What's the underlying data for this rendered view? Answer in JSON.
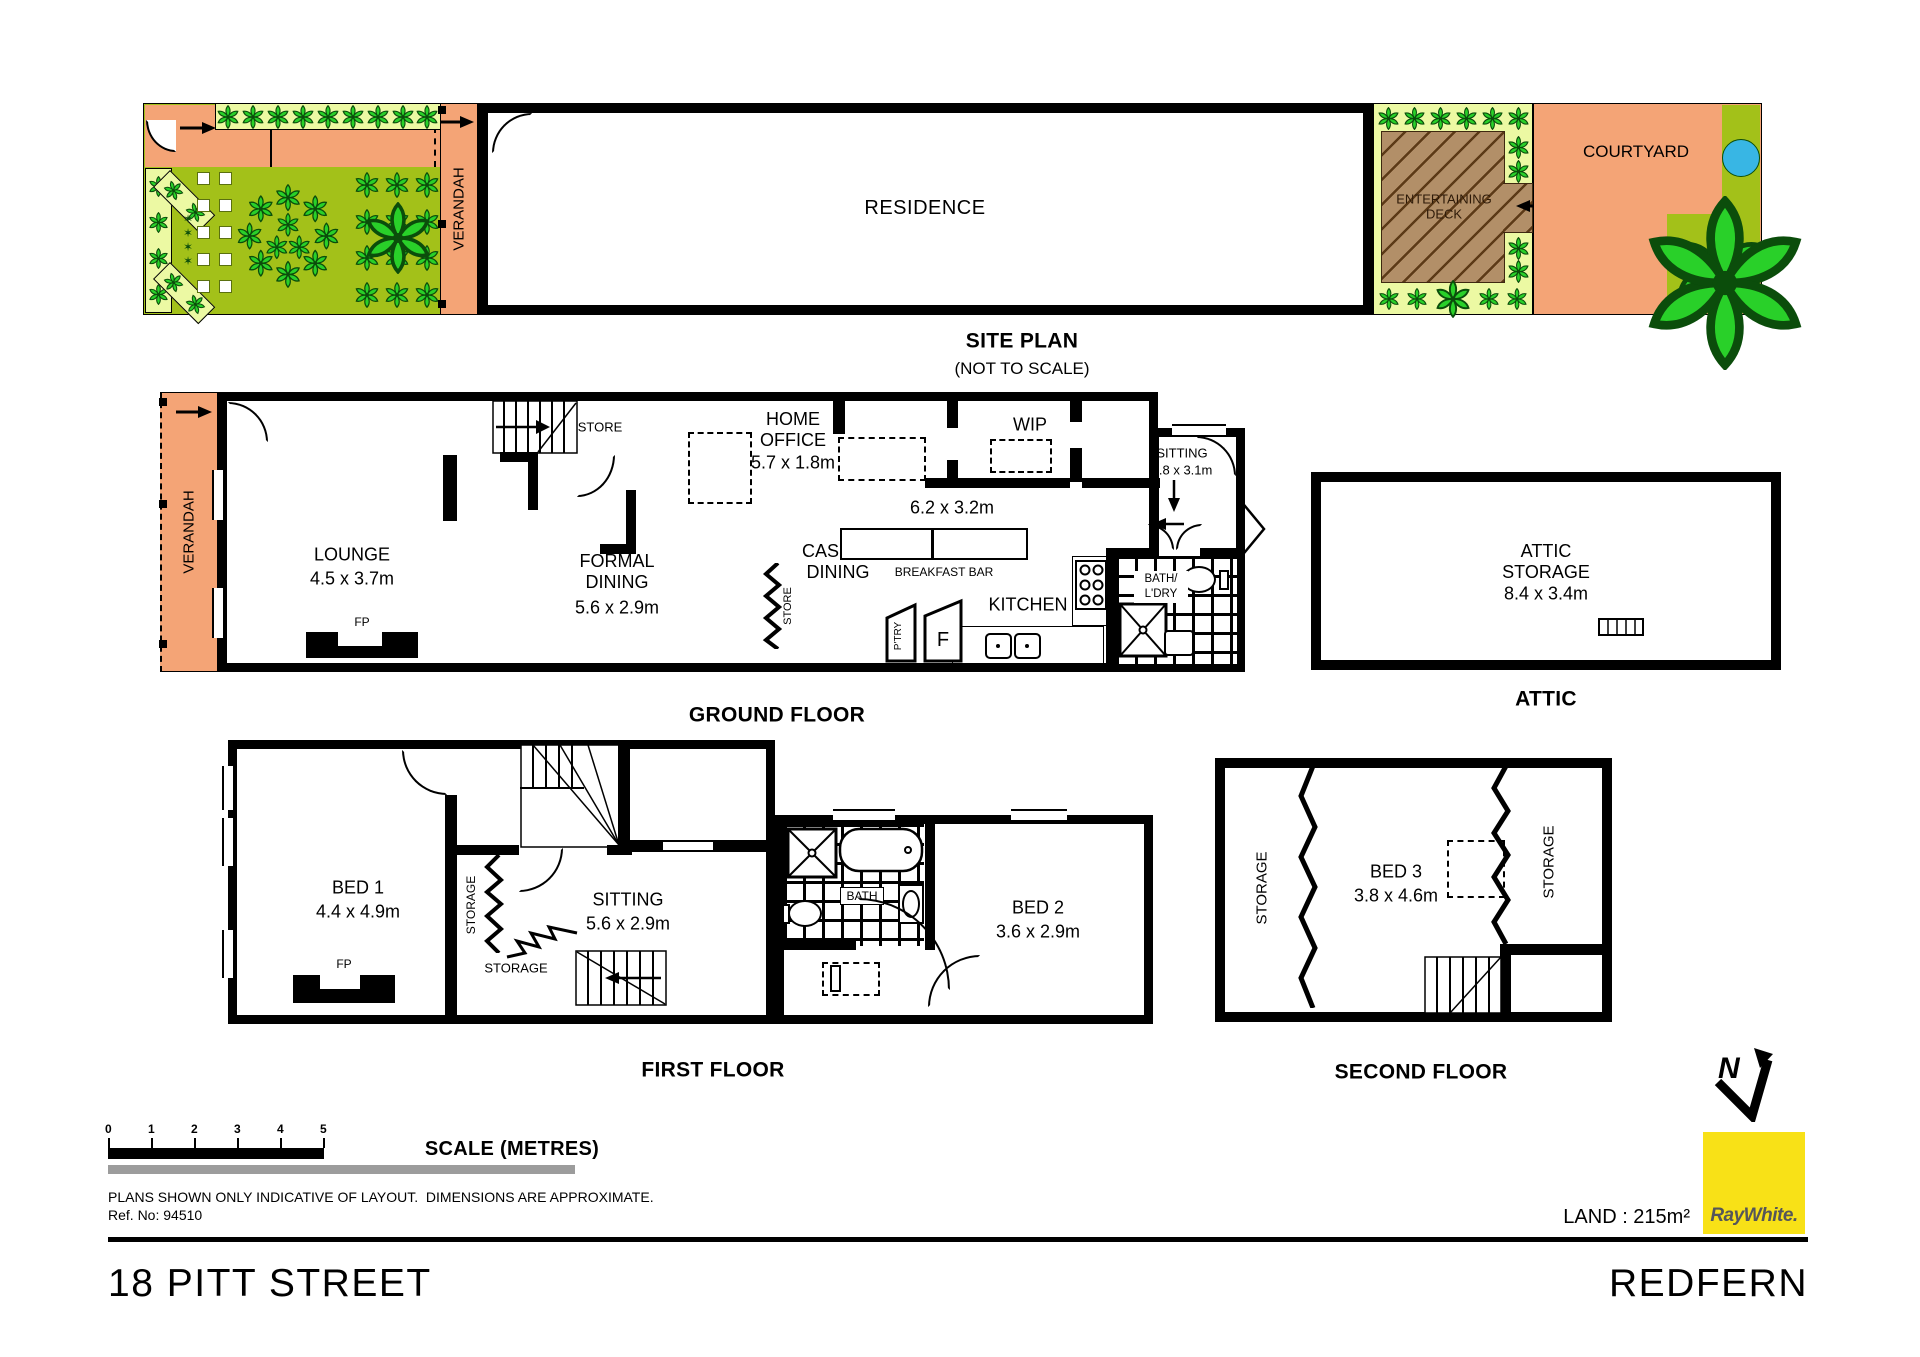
{
  "colors": {
    "salmon": "#F4A476",
    "pale_green": "#ECF9A3",
    "olive_green": "#A3C119",
    "leaf_green": "#29D029",
    "leaf_outline": "#0B4D0B",
    "deck_brown": "#B28F68",
    "pool_blue": "#38B6E4",
    "brand_yellow": "#F8E117",
    "brand_text": "#55565A"
  },
  "site": {
    "title": "SITE PLAN",
    "subtitle": "(NOT TO SCALE)",
    "residence": "RESIDENCE",
    "verandah": "VERANDAH",
    "deck": "ENTERTAINING DECK",
    "courtyard": "COURTYARD"
  },
  "ground": {
    "title": "GROUND FLOOR",
    "verandah": "VERANDAH",
    "lounge_name": "LOUNGE",
    "lounge_dims": "4.5 x 3.7m",
    "formal_name": "FORMAL DINING",
    "formal_dims": "5.6 x 2.9m",
    "casual_name": "CASUAL DINING",
    "office_name": "HOME OFFICE",
    "office_dims": "5.7 x 1.8m",
    "wip": "WIP",
    "kitchen": "KITCHEN",
    "kitchen_dims": "6.2 x 3.2m",
    "breakfast_bar": "BREAKFAST BAR",
    "sitting_name": "SITTING",
    "sitting_dims": "2.8 x 3.1m",
    "bath_line1": "BATH/",
    "bath_line2": "L'DRY",
    "store_upper": "STORE",
    "store_lower": "STORE",
    "pantry": "P'TRY",
    "fridge": "F",
    "fp": "FP"
  },
  "attic": {
    "title": "ATTIC",
    "name": "ATTIC STORAGE",
    "dims": "8.4 x 3.4m"
  },
  "first": {
    "title": "FIRST FLOOR",
    "bed1_name": "BED 1",
    "bed1_dims": "4.4 x 4.9m",
    "sitting_name": "SITTING",
    "sitting_dims": "5.6 x 2.9m",
    "bed2_name": "BED 2",
    "bed2_dims": "3.6 x 2.9m",
    "bath": "BATH",
    "storage_side": "STORAGE",
    "storage_lower": "STORAGE",
    "fp": "FP"
  },
  "second": {
    "title": "SECOND FLOOR",
    "bed3_name": "BED 3",
    "bed3_dims": "3.8 x 4.6m",
    "storage_left": "STORAGE",
    "storage_right": "STORAGE"
  },
  "footer": {
    "scale_title": "SCALE (METRES)",
    "ticks": [
      "0",
      "1",
      "2",
      "3",
      "4",
      "5"
    ],
    "disclaimer": "PLANS SHOWN ONLY INDICATIVE OF LAYOUT.  DIMENSIONS ARE APPROXIMATE.",
    "ref": "Ref. No: 94510",
    "land": "LAND : 215m²",
    "brand": "RayWhite.",
    "north": "N",
    "street": "18 PITT STREET",
    "suburb": "REDFERN"
  }
}
